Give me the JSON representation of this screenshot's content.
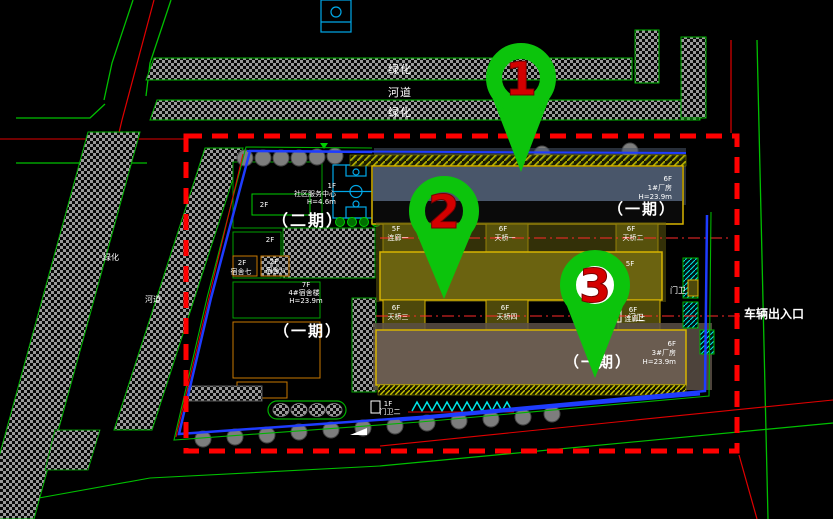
{
  "bands": {
    "green_top": "绿化",
    "river_top": "河道",
    "green_top2": "绿化",
    "green_left": "绿化",
    "river_left": "河道"
  },
  "zones": {
    "phase2": "（二期）",
    "phase1_left": "（一期）",
    "phase1_b1": "（一期）",
    "phase1_b2": "（一期）",
    "phase1_b3": "（一期）"
  },
  "buildings": {
    "factory1": {
      "floors": "6F",
      "name": "1#厂房",
      "height": "H=23.9m"
    },
    "factory3": {
      "floors": "6F",
      "name": "3#厂房",
      "height": "H=23.9m"
    },
    "dormitory4": {
      "floors": "7F",
      "name": "4#宿舍楼",
      "height": "H=23.9m"
    },
    "community": {
      "floors": "1F",
      "name": "社区服务中心",
      "height": "H=4.6m"
    },
    "block_a": {
      "floors": "2F"
    },
    "block_b": {
      "floors": "2F"
    },
    "dorm7": {
      "floors": "2F",
      "name": "宿舍七"
    },
    "dorm8": {
      "floors": "2F",
      "name": "宿舍八"
    },
    "roof_b2": {
      "floors": "5F"
    },
    "gate2": {
      "floors": "1F",
      "name": "门卫二"
    },
    "gate_right": {
      "name": "门卫"
    },
    "gate_right2": {
      "name": "门卫"
    }
  },
  "bridges": {
    "row1": [
      {
        "floors": "5F",
        "name": "连廊一"
      },
      {
        "floors": "6F",
        "name": "天桥一"
      },
      {
        "floors": "6F",
        "name": "天桥二"
      }
    ],
    "row2": [
      {
        "floors": "6F",
        "name": "天桥三"
      },
      {
        "floors": "6F",
        "name": "天桥四"
      },
      {
        "floors": "6F",
        "name": "连廊二"
      }
    ]
  },
  "annotations": {
    "vehicle_entrance": "车辆出入口"
  },
  "pins": [
    {
      "number": "1"
    },
    {
      "number": "2"
    },
    {
      "number": "3"
    }
  ],
  "colors": {
    "pin_green": "#0cc40c",
    "pin_number_red": "#d40000",
    "boundary_red": "#ff0000",
    "parcel_blue": "#1e3cff",
    "road_green": "#00c000",
    "road_red": "#e00000",
    "axis_red": "#ff2a2a",
    "building_outline_yellow": "#d8b400",
    "factory1_fill": "#49566a",
    "factory2_fill": "#6b6310",
    "factory3_fill": "#6a5c50",
    "hatch_gray": "#9a9a9a",
    "court_cyan": "#00a8e8",
    "stair_cyan": "#00e5e5"
  }
}
